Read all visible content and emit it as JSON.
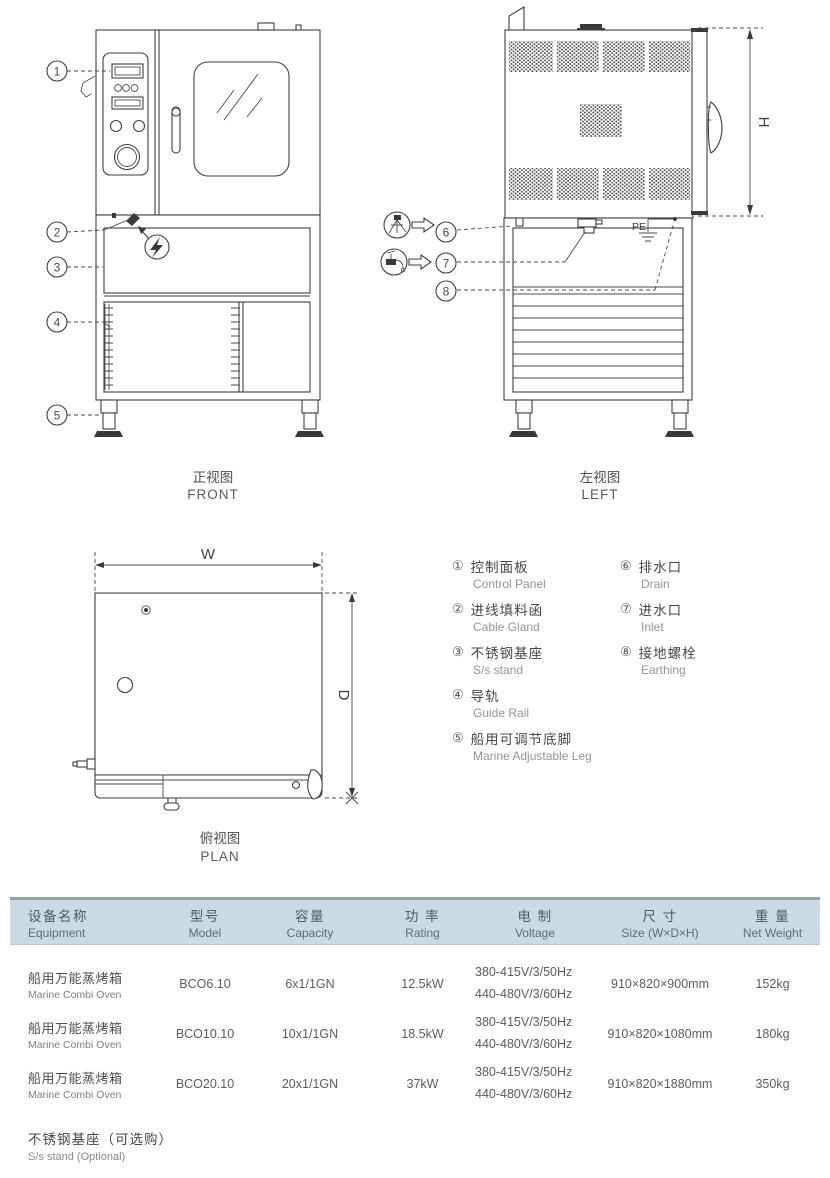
{
  "views": {
    "front": {
      "label_zh": "正视图",
      "label_en": "FRONT",
      "callouts": [
        "1",
        "2",
        "3",
        "4",
        "5"
      ]
    },
    "left": {
      "label_zh": "左视图",
      "label_en": "LEFT",
      "callouts": [
        "6",
        "7",
        "8"
      ],
      "pe": "PE",
      "dim_h": "H"
    },
    "plan": {
      "label_zh": "俯视图",
      "label_en": "PLAN",
      "dim_w": "W",
      "dim_d": "D"
    }
  },
  "legend": {
    "left_items": [
      {
        "num": "①",
        "zh": "控制面板",
        "en": "Control Panel"
      },
      {
        "num": "②",
        "zh": "进线填料函",
        "en": "Cable Gland"
      },
      {
        "num": "③",
        "zh": "不锈钢基座",
        "en": "S/s stand"
      },
      {
        "num": "④",
        "zh": "导轨",
        "en": "Guide Rail"
      },
      {
        "num": "⑤",
        "zh": "船用可调节底脚",
        "en": "Marine Adjustable Leg"
      }
    ],
    "right_items": [
      {
        "num": "⑥",
        "zh": "排水口",
        "en": "Drain"
      },
      {
        "num": "⑦",
        "zh": "进水口",
        "en": "Inlet"
      },
      {
        "num": "⑧",
        "zh": "接地螺栓",
        "en": "Earthing"
      }
    ]
  },
  "table": {
    "columns": [
      {
        "zh": "设备名称",
        "en": "Equipment"
      },
      {
        "zh": "型号",
        "en": "Model"
      },
      {
        "zh": "容量",
        "en": "Capacity"
      },
      {
        "zh": "功 率",
        "en": "Rating"
      },
      {
        "zh": "电 制",
        "en": "Voltage"
      },
      {
        "zh": "尺 寸",
        "en": "Size (W×D×H)"
      },
      {
        "zh": "重 量",
        "en": "Net Weight"
      }
    ],
    "rows": [
      {
        "name_zh": "船用万能蒸烤箱",
        "name_en": "Marine Combi Oven",
        "model": "BCO6.10",
        "capacity": "6x1/1GN",
        "rating": "12.5kW",
        "voltage_1": "380-415V/3/50Hz",
        "voltage_2": "440-480V/3/60Hz",
        "size": "910×820×900mm",
        "weight": "152kg"
      },
      {
        "name_zh": "船用万能蒸烤箱",
        "name_en": "Marine Combi Oven",
        "model": "BCO10.10",
        "capacity": "10x1/1GN",
        "rating": "18.5kW",
        "voltage_1": "380-415V/3/50Hz",
        "voltage_2": "440-480V/3/60Hz",
        "size": "910×820×1080mm",
        "weight": "180kg"
      },
      {
        "name_zh": "船用万能蒸烤箱",
        "name_en": "Marine Combi Oven",
        "model": "BCO20.10",
        "capacity": "20x1/1GN",
        "rating": "37kW",
        "voltage_1": "380-415V/3/50Hz",
        "voltage_2": "440-480V/3/60Hz",
        "size": "910×820×1880mm",
        "weight": "350kg"
      }
    ],
    "footnote_zh": "不锈钢基座（可选购）",
    "footnote_en": "S/s stand (Optional)"
  },
  "colors": {
    "header_bg": "#cbd9e2",
    "header_border": "#97a2a8",
    "drawing_line": "#3f3f3f",
    "text": "#565656",
    "text_light": "#8f8f8f"
  }
}
